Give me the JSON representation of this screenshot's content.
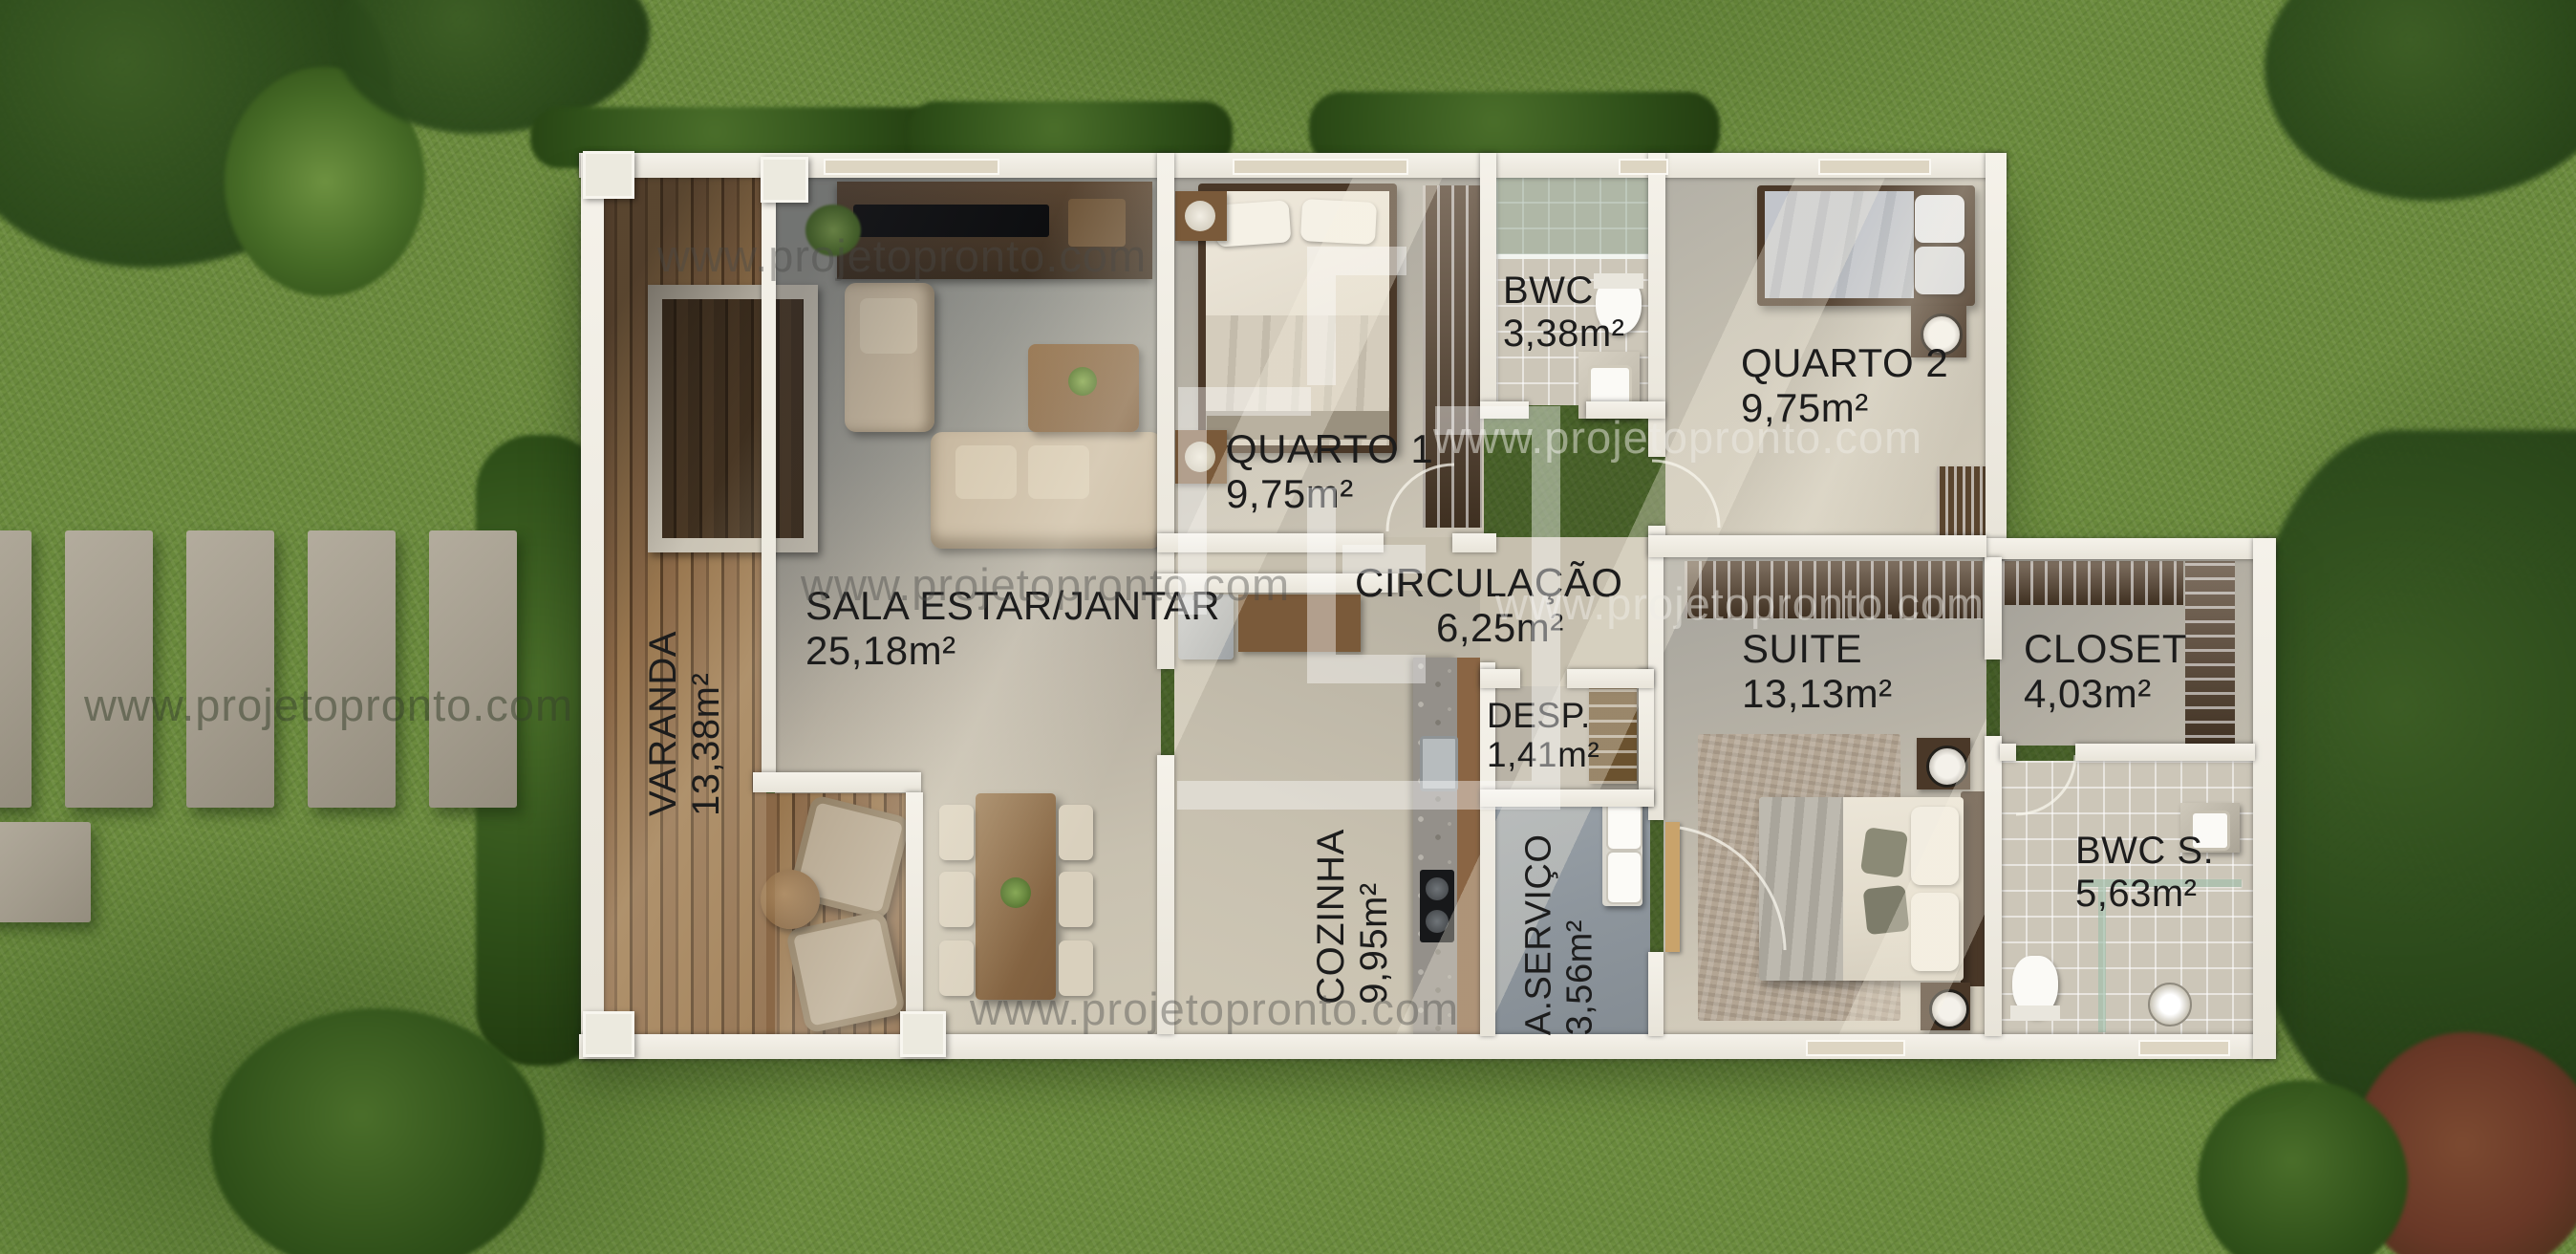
{
  "watermark": {
    "text": "www.projetopronto.com"
  },
  "rooms": [
    {
      "id": "varanda",
      "name": "VARANDA",
      "area": "13,38m²"
    },
    {
      "id": "sala",
      "name": "SALA ESTAR/JANTAR",
      "area": "25,18m²"
    },
    {
      "id": "quarto1",
      "name": "QUARTO 1",
      "area": "9,75m²"
    },
    {
      "id": "bwc",
      "name": "BWC",
      "area": "3,38m²"
    },
    {
      "id": "quarto2",
      "name": "QUARTO 2",
      "area": "9,75m²"
    },
    {
      "id": "circulacao",
      "name": "CIRCULAÇÃO",
      "area": "6,25m²"
    },
    {
      "id": "desp",
      "name": "DESP.",
      "area": "1,41m²"
    },
    {
      "id": "cozinha",
      "name": "COZINHA",
      "area": "9,95m²"
    },
    {
      "id": "aservico",
      "name": "A.SERVIÇO",
      "area": "3,56m²"
    },
    {
      "id": "suite",
      "name": "SUITE",
      "area": "13,13m²"
    },
    {
      "id": "closet",
      "name": "CLOSET",
      "area": "4,03m²"
    },
    {
      "id": "bwcs",
      "name": "BWC S.",
      "area": "5,63m²"
    }
  ],
  "colors": {
    "grass": "#69893c",
    "deck_wood": "#8a6847",
    "wall_white": "#f5f2ea",
    "floor_light": "#c9c2b1",
    "floor_gray": "#8f9194",
    "suite_floor": "#a9a7a0",
    "service_floor": "#8d959c",
    "tile": "#ccc6b8",
    "label_text": "#1c1c1c",
    "watermark_gray": "#6b6b6b"
  }
}
